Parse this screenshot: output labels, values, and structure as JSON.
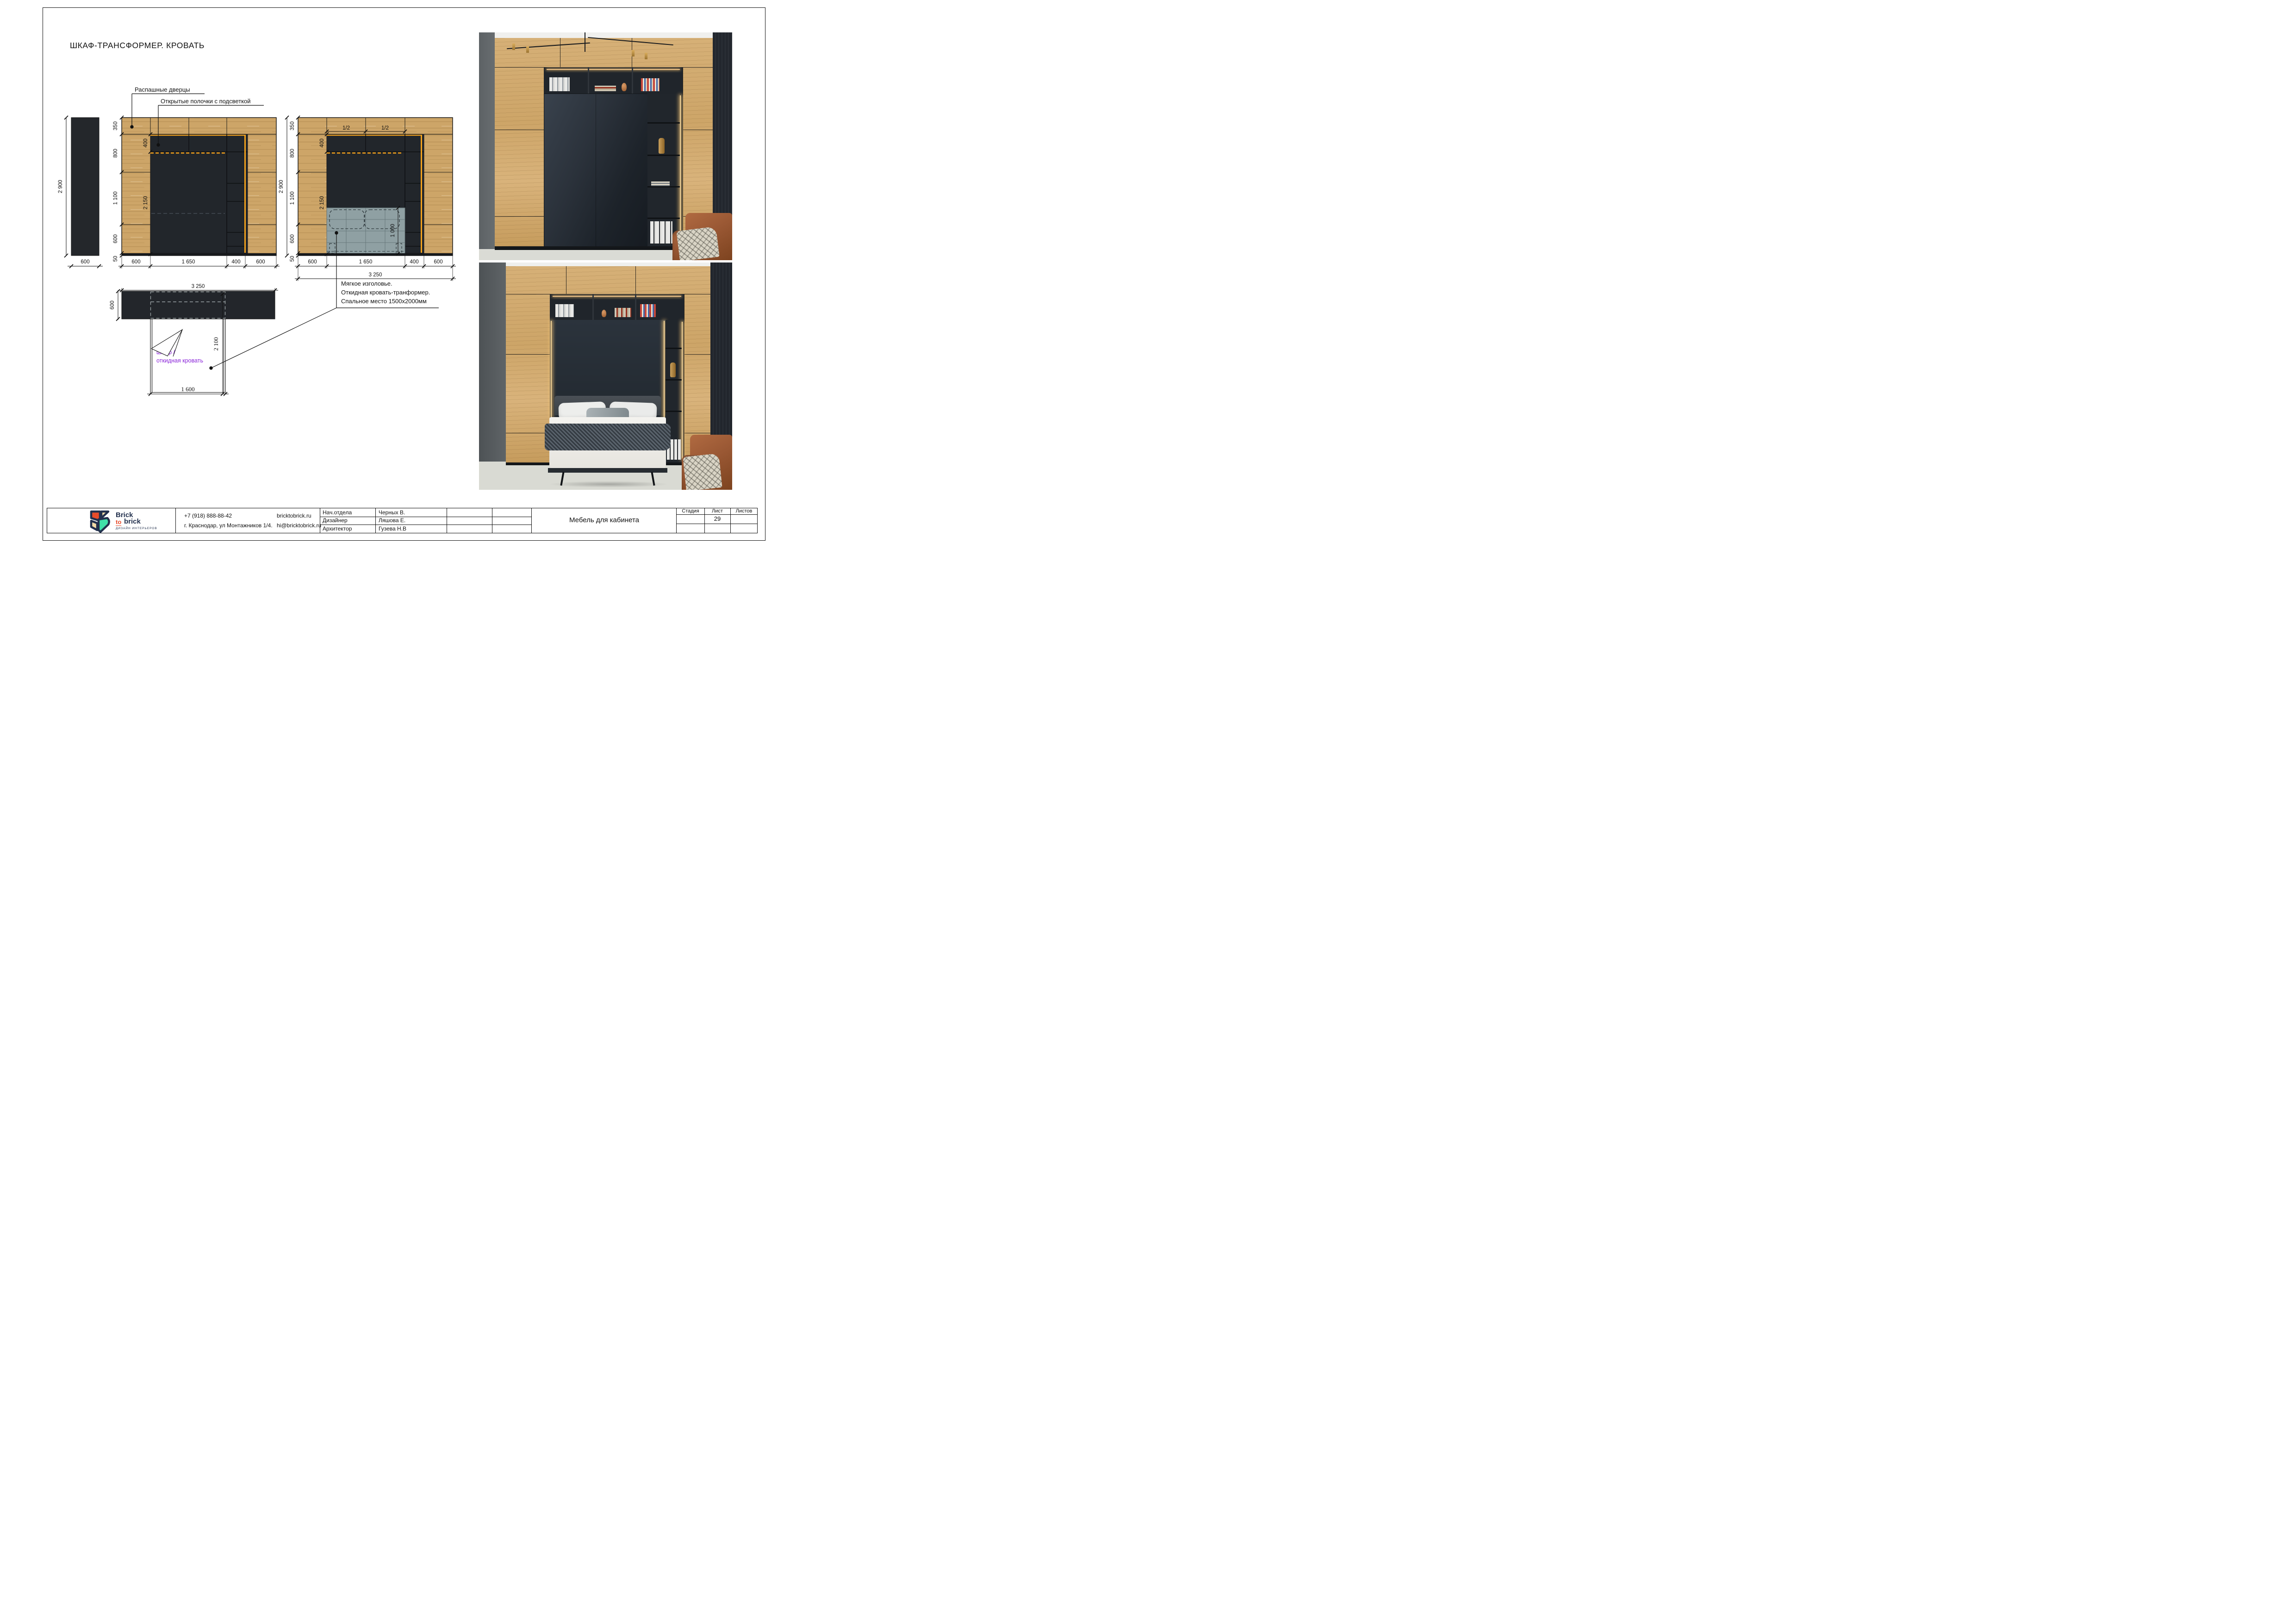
{
  "sheet": {
    "title": "ШКАФ-ТРАНСФОРМЕР. КРОВАТЬ"
  },
  "callouts": {
    "hinged_doors": "Распашные дверцы",
    "open_shelves": "Открытые полочки с подсветкой"
  },
  "note": {
    "line1": "Мягкое изголовье.",
    "line2": "Откидная кровать-транформер.",
    "line3": "Спальное место 1500х2000мм"
  },
  "side_section": {
    "height": "2 900",
    "width": "600"
  },
  "elev_closed": {
    "left_dims": [
      "350",
      "800",
      "1 100",
      "600",
      "50"
    ],
    "inner_dims": [
      "400",
      "2 150"
    ],
    "bottom_dims": [
      "600",
      "1 650",
      "400",
      "600"
    ]
  },
  "elev_open": {
    "height": "2 900",
    "left_dims": [
      "350",
      "800",
      "1 100",
      "600",
      "50"
    ],
    "inner_dims": [
      "400",
      "2 150"
    ],
    "top_half_dims": [
      "1/2",
      "1/2"
    ],
    "headboard_height": "1 000",
    "bottom_dims": [
      "600",
      "1 650",
      "400",
      "600"
    ],
    "total_width": "3 250"
  },
  "plan": {
    "total_width": "3 250",
    "depth": "600",
    "bed_length": "2 100",
    "bed_width": "1 600",
    "label_line1": "шкаф /",
    "label_line2": "откидная кровать"
  },
  "title_block": {
    "logo": {
      "word1": "Brick",
      "word2": "to",
      "word3": "brick",
      "tagline": "ДИЗАЙН ИНТЕРЬЕРОВ"
    },
    "contacts": {
      "phone": "+7 (918)  888-88-42",
      "address": "г. Краснодар, ул Монтажников 1/4.",
      "website": "bricktobrick.ru",
      "email": "hi@bricktobrick.ru"
    },
    "staff": [
      {
        "role": "Нач.отдела",
        "name": "Черных В."
      },
      {
        "role": "Дизайнер",
        "name": "Ляшова Е."
      },
      {
        "role": "Архитектор",
        "name": "Гузева  Н.В"
      }
    ],
    "project_title": "Мебель для кабинета",
    "stage_label": "Стадия",
    "sheet_label": "Лист",
    "sheets_label": "Листов",
    "sheet_number": "29"
  },
  "colors": {
    "wood": "#cda568",
    "dark_panel": "#23262b",
    "accent_orange": "#f4a21c",
    "headboard_gray": "#8fa0a3",
    "plan_label_purple": "#8a24d9",
    "logo_navy": "#22304d",
    "logo_red": "#e84c2b",
    "logo_cream": "#f2dba6",
    "logo_teal": "#3fe0a8"
  }
}
